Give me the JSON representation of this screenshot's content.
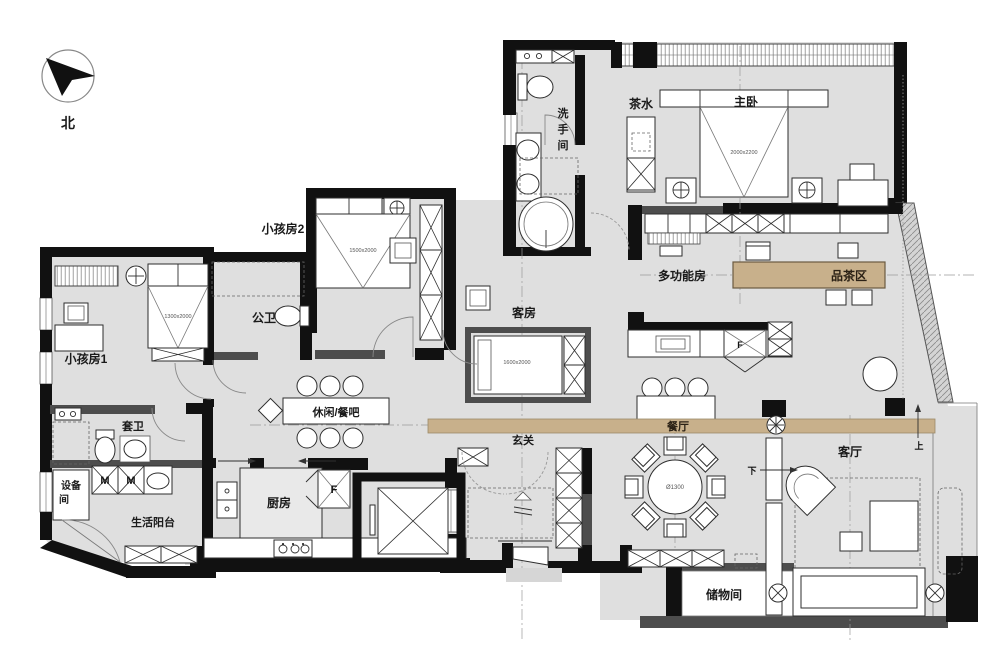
{
  "title": "Apartment floor plan",
  "compass": {
    "north_label": "北"
  },
  "rooms": {
    "kids2": "小孩房2",
    "kids1": "小孩房1",
    "public_bath": "公卫",
    "washroom_chars": [
      "洗",
      "手",
      "间"
    ],
    "tea_pantry": "茶水",
    "master": "主卧",
    "multi_function": "多功能房",
    "tea_area": "品茶区",
    "guest": "客房",
    "leisure_bar": "休闲/餐吧",
    "ensuite": "套卫",
    "equipment_line1": "设备",
    "equipment_line2": "间",
    "service_balcony": "生活阳台",
    "kitchen": "厨房",
    "foyer": "玄关",
    "dining": "餐厅",
    "living": "客厅",
    "storage": "储物间"
  },
  "dimensions": {
    "master_bed": "2000x2200",
    "kids2_bed": "1500x2000",
    "kids1_bed": "1300x2000",
    "guest_bed": "1600x2000",
    "dining_table": "Ø1300"
  },
  "markers": {
    "fridge": "F",
    "fridge2": "F",
    "washer1": "M",
    "washer2": "M",
    "stairs_up": "上",
    "stairs_down": "下"
  },
  "colors": {
    "floor": "#dfdfdf",
    "wall": "#111111",
    "wall_gray": "#4d4d4d",
    "accent_wood": "#c8b08b",
    "outline": "#2e2e2e"
  }
}
